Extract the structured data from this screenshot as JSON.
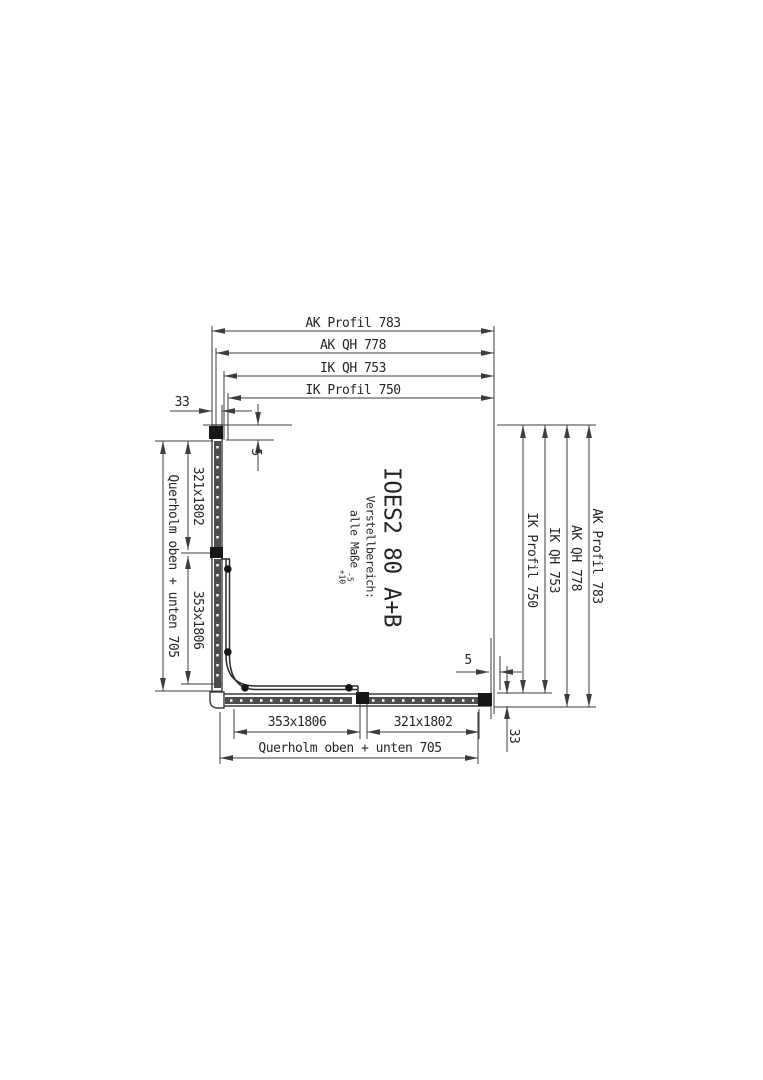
{
  "product": {
    "code": "IOES2 80 A+B",
    "adjustment": {
      "label": "Verstellbereich:",
      "scope": "alle Maße",
      "tolerance_minus": "-5",
      "tolerance_plus": "+10"
    }
  },
  "dims": {
    "top": [
      "AK Profil 783",
      "AK QH 778",
      "IK QH 753",
      "IK Profil 750"
    ],
    "right": [
      "IK Profil 750",
      "IK QH 753",
      "AK QH 778",
      "AK Profil 783"
    ],
    "left": {
      "outer": "Querholm oben + unten 705",
      "segment_top": "321x1802",
      "segment_bottom": "353x1806"
    },
    "bottom": {
      "segment_left": "353x1806",
      "segment_right": "321x1802",
      "outer": "Querholm oben + unten 705"
    },
    "small": {
      "top_left_profile_width": "33",
      "top_left_gap": "5",
      "bottom_right_gap": "5",
      "bottom_right_profile_width": "33"
    }
  },
  "colors": {
    "line": "#3d3d3d",
    "text": "#262626",
    "glass_fill": "#4d4d4d",
    "cap_fill": "#161616",
    "background": "#ffffff"
  }
}
